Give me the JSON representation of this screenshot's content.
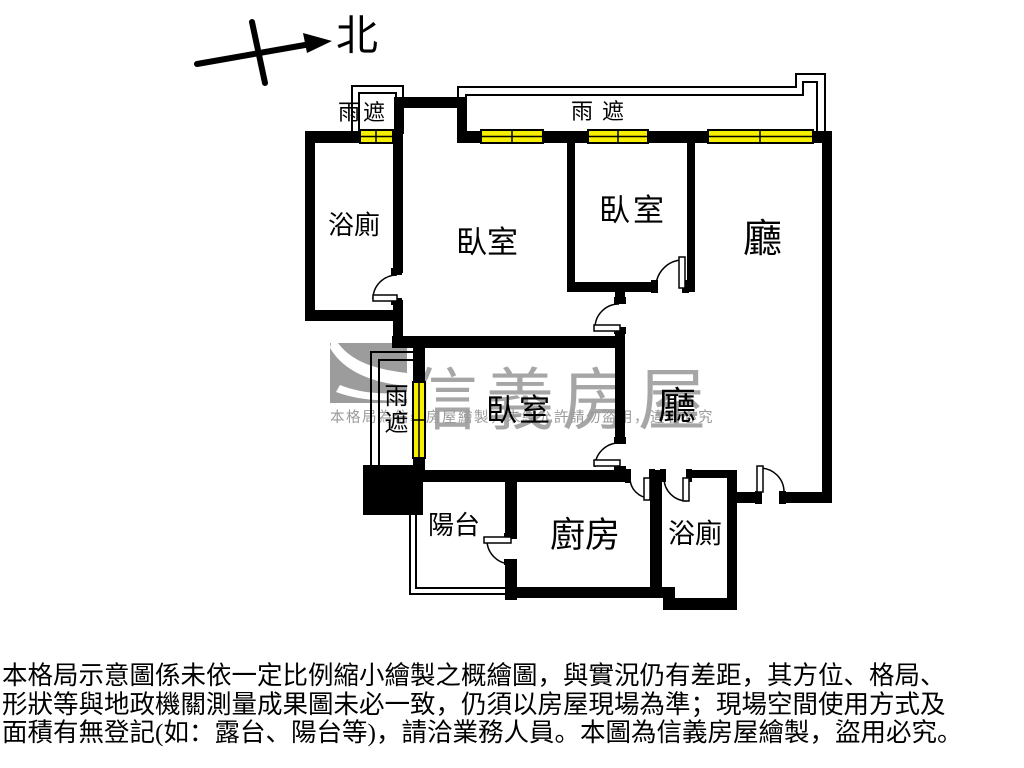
{
  "compass": {
    "label": "北"
  },
  "canopy_labels": {
    "top_left": "雨遮",
    "top_center": "雨遮",
    "side_vertical": "雨遮"
  },
  "rooms": {
    "bathroom_top": "浴廁",
    "bedroom_main": "臥室",
    "bedroom_top": "臥室",
    "living_top": "廳",
    "bedroom_lower": "臥室",
    "living_lower": "廳",
    "balcony": "陽台",
    "kitchen": "廚房",
    "bathroom_bottom": "浴廁"
  },
  "watermark": {
    "brand": "信義房屋",
    "notice": "本格局為信義房屋繪製，未經允許請勿盜用，違者必究"
  },
  "disclaimer": {
    "line1": "本格局示意圖係未依一定比例縮小繪製之概繪圖，與實況仍有差距，其方位、格局、",
    "line2": "形狀等與地政機關測量成果圖未必一致，仍須以房屋現場為準；現場空間使用方式及",
    "line3": "面積有無登記(如：露台、陽台等)，請洽業務人員。本圖為信義房屋繪製，盜用必究。"
  },
  "colors": {
    "wall": "#000000",
    "window_fill": "#f7ef00",
    "watermark_gray": "#a6a6a6"
  }
}
